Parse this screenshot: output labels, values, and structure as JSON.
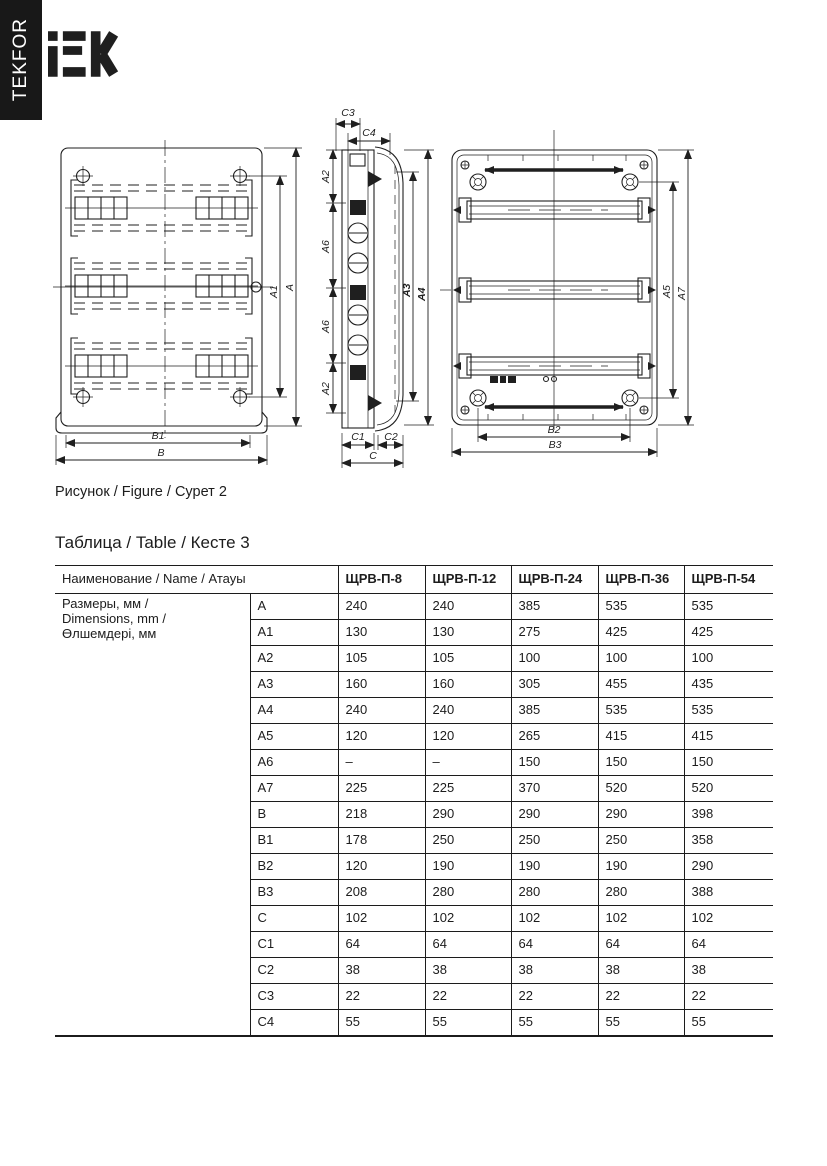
{
  "brand": {
    "vertical_tab": "TEKFOR",
    "logo": "iEK"
  },
  "figure": {
    "caption": "Рисунок / Figure / Сурет 2",
    "labels": {
      "a": "A",
      "a1": "A1",
      "a2": "A2",
      "a3": "A3",
      "a4": "A4",
      "a5": "A5",
      "a6": "A6",
      "a7": "A7",
      "b": "B",
      "b1": "B1",
      "b2": "B2",
      "b3": "B3",
      "c": "C",
      "c1": "C1",
      "c2": "C2",
      "c3": "C3",
      "c4": "C4"
    }
  },
  "table": {
    "caption": "Таблица / Table / Кесте 3",
    "name_header": "Наименование / Name / Атауы",
    "models": [
      "ЩРВ-П-8",
      "ЩРВ-П-12",
      "ЩРВ-П-24",
      "ЩРВ-П-36",
      "ЩРВ-П-54"
    ],
    "group_label_lines": [
      "Размеры, мм /",
      "Dimensions, mm /",
      "Өлшемдері, мм"
    ],
    "rows": [
      {
        "dim": "A",
        "values": [
          "240",
          "240",
          "385",
          "535",
          "535"
        ]
      },
      {
        "dim": "A1",
        "values": [
          "130",
          "130",
          "275",
          "425",
          "425"
        ]
      },
      {
        "dim": "A2",
        "values": [
          "105",
          "105",
          "100",
          "100",
          "100"
        ]
      },
      {
        "dim": "A3",
        "values": [
          "160",
          "160",
          "305",
          "455",
          "435"
        ]
      },
      {
        "dim": "A4",
        "values": [
          "240",
          "240",
          "385",
          "535",
          "535"
        ]
      },
      {
        "dim": "A5",
        "values": [
          "120",
          "120",
          "265",
          "415",
          "415"
        ]
      },
      {
        "dim": "A6",
        "values": [
          "–",
          "–",
          "150",
          "150",
          "150"
        ]
      },
      {
        "dim": "A7",
        "values": [
          "225",
          "225",
          "370",
          "520",
          "520"
        ]
      },
      {
        "dim": "B",
        "values": [
          "218",
          "290",
          "290",
          "290",
          "398"
        ]
      },
      {
        "dim": "B1",
        "values": [
          "178",
          "250",
          "250",
          "250",
          "358"
        ]
      },
      {
        "dim": "B2",
        "values": [
          "120",
          "190",
          "190",
          "190",
          "290"
        ]
      },
      {
        "dim": "B3",
        "values": [
          "208",
          "280",
          "280",
          "280",
          "388"
        ]
      },
      {
        "dim": "C",
        "values": [
          "102",
          "102",
          "102",
          "102",
          "102"
        ]
      },
      {
        "dim": "C1",
        "values": [
          "64",
          "64",
          "64",
          "64",
          "64"
        ]
      },
      {
        "dim": "C2",
        "values": [
          "38",
          "38",
          "38",
          "38",
          "38"
        ]
      },
      {
        "dim": "C3",
        "values": [
          "22",
          "22",
          "22",
          "22",
          "22"
        ]
      },
      {
        "dim": "C4",
        "values": [
          "55",
          "55",
          "55",
          "55",
          "55"
        ]
      }
    ]
  }
}
